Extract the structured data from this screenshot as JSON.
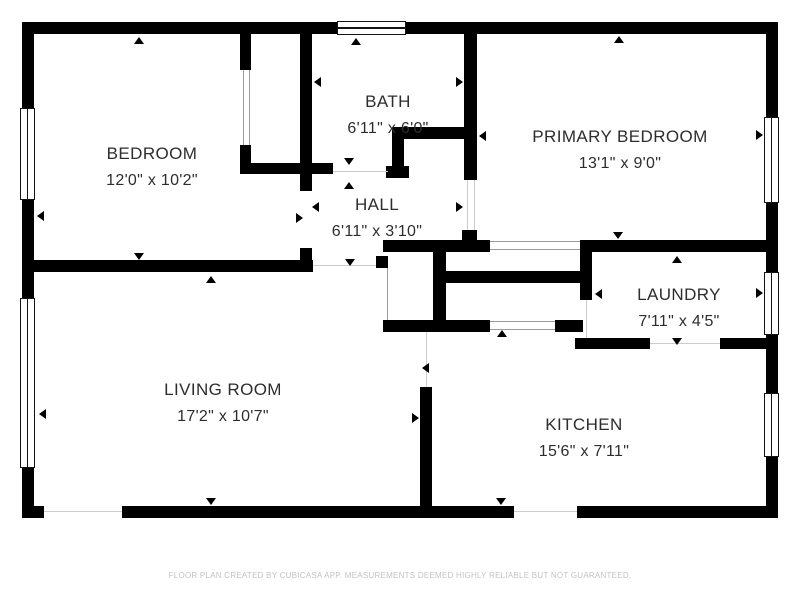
{
  "footer": {
    "text": "FLOOR PLAN CREATED BY CUBICASA APP. MEASUREMENTS DEEMED HIGHLY RELIABLE BUT NOT GUARANTEED.",
    "y": 571
  },
  "colors": {
    "wall": "#000000",
    "room_text": "#2d2d2d",
    "footer_text": "#c3c3c3",
    "opening_line": "#cccccc",
    "door_line": "#9a9a9a"
  },
  "floorplan": {
    "rooms": [
      {
        "name": "BEDROOM",
        "dims": "12'0\" x 10'2\"",
        "cx": 152,
        "top": 144
      },
      {
        "name": "BATH",
        "dims": "6'11\" x 6'0\"",
        "cx": 388,
        "top": 92
      },
      {
        "name": "PRIMARY BEDROOM",
        "dims": "13'1\" x 9'0\"",
        "cx": 620,
        "top": 127
      },
      {
        "name": "HALL",
        "dims": "6'11\" x 3'10\"",
        "cx": 377,
        "top": 195
      },
      {
        "name": "LAUNDRY",
        "dims": "7'11\" x 4'5\"",
        "cx": 679,
        "top": 285
      },
      {
        "name": "LIVING ROOM",
        "dims": "17'2\" x 10'7\"",
        "cx": 223,
        "top": 380
      },
      {
        "name": "KITCHEN",
        "dims": "15'6\" x 7'11\"",
        "cx": 584,
        "top": 415
      }
    ],
    "walls": [
      [
        22,
        22,
        315,
        12
      ],
      [
        406,
        22,
        372,
        12
      ],
      [
        22,
        22,
        12,
        86
      ],
      [
        22,
        200,
        12,
        98
      ],
      [
        22,
        468,
        12,
        50
      ],
      [
        766,
        22,
        12,
        95
      ],
      [
        766,
        203,
        12,
        69
      ],
      [
        766,
        335,
        12,
        58
      ],
      [
        766,
        457,
        12,
        61
      ],
      [
        22,
        506,
        22,
        12
      ],
      [
        122,
        506,
        392,
        12
      ],
      [
        577,
        506,
        201,
        12
      ],
      [
        240,
        34,
        11,
        36
      ],
      [
        240,
        145,
        11,
        29
      ],
      [
        240,
        163,
        93,
        11
      ],
      [
        300,
        34,
        12,
        157
      ],
      [
        300,
        248,
        12,
        14
      ],
      [
        22,
        260,
        291,
        12
      ],
      [
        392,
        127,
        74,
        12
      ],
      [
        392,
        139,
        12,
        28
      ],
      [
        386,
        166,
        23,
        12
      ],
      [
        464,
        34,
        13,
        146
      ],
      [
        462,
        230,
        15,
        22
      ],
      [
        383,
        240,
        107,
        12
      ],
      [
        580,
        240,
        186,
        12
      ],
      [
        446,
        271,
        137,
        12
      ],
      [
        433,
        240,
        13,
        92
      ],
      [
        383,
        320,
        107,
        12
      ],
      [
        555,
        320,
        28,
        12
      ],
      [
        376,
        256,
        12,
        12
      ],
      [
        580,
        240,
        12,
        60
      ],
      [
        575,
        338,
        75,
        11
      ],
      [
        720,
        338,
        46,
        11
      ],
      [
        420,
        387,
        12,
        119
      ]
    ],
    "windows": [
      {
        "x": 337,
        "y": 21,
        "w": 69,
        "h": 14,
        "o": "h"
      },
      {
        "x": 20,
        "y": 108,
        "w": 15,
        "h": 92,
        "o": "v"
      },
      {
        "x": 20,
        "y": 298,
        "w": 15,
        "h": 170,
        "o": "v"
      },
      {
        "x": 764,
        "y": 117,
        "w": 15,
        "h": 86,
        "o": "v"
      },
      {
        "x": 764,
        "y": 272,
        "w": 15,
        "h": 63,
        "o": "v"
      },
      {
        "x": 764,
        "y": 393,
        "w": 15,
        "h": 64,
        "o": "v"
      }
    ],
    "mullions": [
      [
        20,
        351,
        15,
        3
      ],
      [
        20,
        357,
        15,
        3
      ],
      [
        20,
        408,
        15,
        3
      ],
      [
        20,
        415,
        15,
        3
      ]
    ],
    "openings": [
      {
        "x": 333,
        "y": 171,
        "w": 55,
        "h": 1,
        "k": "thin"
      },
      {
        "x": 313,
        "y": 265,
        "w": 63,
        "h": 1,
        "k": "thin"
      },
      {
        "x": 426,
        "y": 332,
        "w": 1,
        "h": 55,
        "k": "thin"
      },
      {
        "x": 44,
        "y": 511,
        "w": 78,
        "h": 1,
        "k": "thin"
      },
      {
        "x": 514,
        "y": 511,
        "w": 63,
        "h": 1,
        "k": "thin"
      },
      {
        "x": 586,
        "y": 300,
        "w": 1,
        "h": 38,
        "k": "thin"
      },
      {
        "x": 650,
        "y": 343,
        "w": 70,
        "h": 1,
        "k": "thin"
      },
      {
        "x": 467,
        "y": 180,
        "w": 1,
        "h": 50,
        "k": "thin"
      },
      {
        "x": 474,
        "y": 180,
        "w": 1,
        "h": 50,
        "k": "thin"
      },
      {
        "x": 387,
        "y": 268,
        "w": 1,
        "h": 52,
        "k": "door"
      },
      {
        "x": 490,
        "y": 241,
        "w": 90,
        "h": 1,
        "k": "door"
      },
      {
        "x": 490,
        "y": 249,
        "w": 90,
        "h": 1,
        "k": "door"
      },
      {
        "x": 490,
        "y": 321,
        "w": 65,
        "h": 1,
        "k": "door"
      },
      {
        "x": 490,
        "y": 329,
        "w": 65,
        "h": 1,
        "k": "door"
      },
      {
        "x": 243,
        "y": 70,
        "w": 1,
        "h": 75,
        "k": "door"
      },
      {
        "x": 249,
        "y": 70,
        "w": 1,
        "h": 75,
        "k": "door"
      }
    ],
    "arrows": [
      {
        "x": 139,
        "y": 38,
        "d": "up"
      },
      {
        "x": 356,
        "y": 39,
        "d": "up"
      },
      {
        "x": 619,
        "y": 37,
        "d": "up"
      },
      {
        "x": 677,
        "y": 257,
        "d": "up"
      },
      {
        "x": 211,
        "y": 277,
        "d": "up"
      },
      {
        "x": 349,
        "y": 183,
        "d": "up"
      },
      {
        "x": 502,
        "y": 331,
        "d": "up"
      },
      {
        "x": 139,
        "y": 256,
        "d": "down"
      },
      {
        "x": 350,
        "y": 262,
        "d": "down"
      },
      {
        "x": 618,
        "y": 235,
        "d": "down"
      },
      {
        "x": 677,
        "y": 341,
        "d": "down"
      },
      {
        "x": 211,
        "y": 501,
        "d": "down"
      },
      {
        "x": 501,
        "y": 501,
        "d": "down"
      },
      {
        "x": 349,
        "y": 161,
        "d": "down"
      },
      {
        "x": 38,
        "y": 216,
        "d": "left"
      },
      {
        "x": 40,
        "y": 414,
        "d": "left"
      },
      {
        "x": 315,
        "y": 82,
        "d": "left"
      },
      {
        "x": 313,
        "y": 207,
        "d": "left"
      },
      {
        "x": 480,
        "y": 136,
        "d": "left"
      },
      {
        "x": 596,
        "y": 294,
        "d": "left"
      },
      {
        "x": 423,
        "y": 368,
        "d": "left"
      },
      {
        "x": 299,
        "y": 218,
        "d": "right"
      },
      {
        "x": 459,
        "y": 82,
        "d": "right"
      },
      {
        "x": 459,
        "y": 207,
        "d": "right"
      },
      {
        "x": 415,
        "y": 418,
        "d": "right"
      },
      {
        "x": 759,
        "y": 135,
        "d": "right"
      },
      {
        "x": 759,
        "y": 293,
        "d": "right"
      }
    ]
  }
}
